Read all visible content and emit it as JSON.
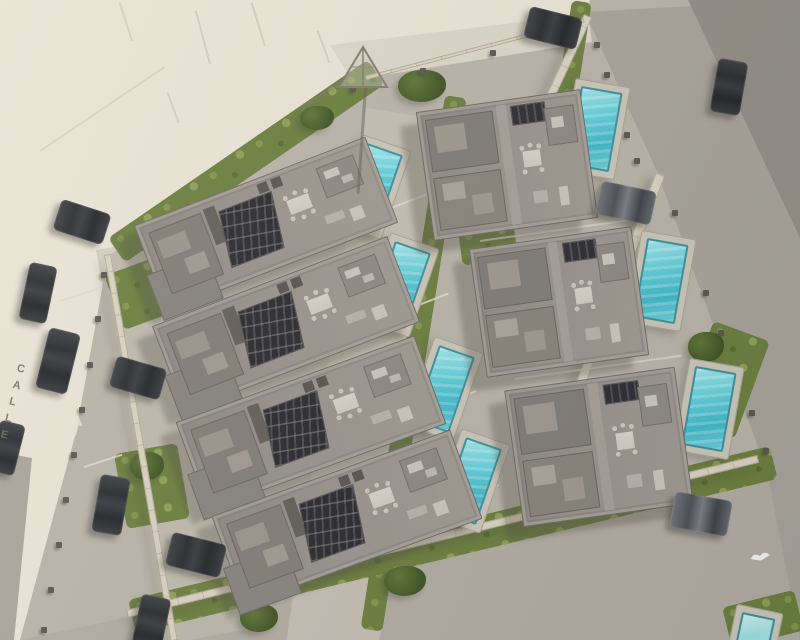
{
  "scene": {
    "description": "Aerial 3D render of a walled residential development with modern villas, rooftop terraces with solar panels, and private turquoise pools, bordered by streets with parked cars",
    "street_label": "CALLE",
    "site": {
      "villas_left_column": 4,
      "villas_right_column": 3,
      "pools_visible": 8,
      "parked_cars": 12
    },
    "colors": {
      "terrain": "#e9e3d6",
      "street": "#c8c3b6",
      "road": "#a5a198",
      "road_dark": "#908c84",
      "concrete": "#b7b2a7",
      "deck": "#c9c4b7",
      "roof": "#918d86",
      "roof_dark": "#7d7972",
      "solar": "#2a2a2e",
      "pool_water": "#52c6d2",
      "pool_light": "#9ce4e8",
      "grass": "#687c3b",
      "wall": "#d8d1c0",
      "car": "#2f3236",
      "shadow": "rgba(72,69,62,0.33)"
    },
    "villas": [
      {
        "id": "villa-L1",
        "type": "left",
        "x": 142,
        "y": 178,
        "w": 248,
        "h": 92,
        "rot": -21
      },
      {
        "id": "villa-L2",
        "type": "left",
        "x": 160,
        "y": 278,
        "w": 252,
        "h": 92,
        "rot": -21
      },
      {
        "id": "villa-L3",
        "type": "left",
        "x": 184,
        "y": 376,
        "w": 254,
        "h": 94,
        "rot": -20
      },
      {
        "id": "villa-L4",
        "type": "left",
        "x": 220,
        "y": 470,
        "w": 254,
        "h": 95,
        "rot": -20
      },
      {
        "id": "villa-R1",
        "type": "right",
        "x": 424,
        "y": 100,
        "w": 166,
        "h": 130,
        "rot": -8
      },
      {
        "id": "villa-R2",
        "type": "right",
        "x": 477,
        "y": 237,
        "w": 164,
        "h": 130,
        "rot": -8
      },
      {
        "id": "villa-R3",
        "type": "right",
        "x": 513,
        "y": 378,
        "w": 172,
        "h": 138,
        "rot": -8
      }
    ],
    "pools": [
      {
        "x": 346,
        "y": 140,
        "w": 52,
        "h": 94,
        "rot": 19,
        "partial": false
      },
      {
        "x": 374,
        "y": 238,
        "w": 52,
        "h": 94,
        "rot": 19,
        "partial": false
      },
      {
        "x": 418,
        "y": 342,
        "w": 52,
        "h": 94,
        "rot": 19,
        "partial": false
      },
      {
        "x": 445,
        "y": 434,
        "w": 52,
        "h": 94,
        "rot": 19,
        "partial": false
      },
      {
        "x": 567,
        "y": 82,
        "w": 56,
        "h": 94,
        "rot": 10,
        "partial": false
      },
      {
        "x": 633,
        "y": 234,
        "w": 56,
        "h": 94,
        "rot": 10,
        "partial": false
      },
      {
        "x": 681,
        "y": 362,
        "w": 56,
        "h": 94,
        "rot": 10,
        "partial": false
      },
      {
        "x": 730,
        "y": 608,
        "w": 48,
        "h": 60,
        "rot": 12,
        "partial": true
      }
    ],
    "cars": [
      {
        "x": 56,
        "y": 206,
        "w": 52,
        "h": 32,
        "rot": 18,
        "tone": "dark-h"
      },
      {
        "x": 24,
        "y": 264,
        "w": 28,
        "h": 58,
        "rot": 12,
        "tone": "dark"
      },
      {
        "x": 42,
        "y": 330,
        "w": 32,
        "h": 62,
        "rot": 14,
        "tone": "dark"
      },
      {
        "x": 96,
        "y": 476,
        "w": 30,
        "h": 58,
        "rot": 10,
        "tone": "dark"
      },
      {
        "x": -6,
        "y": 422,
        "w": 26,
        "h": 52,
        "rot": 14,
        "tone": "dark"
      },
      {
        "x": 136,
        "y": 596,
        "w": 30,
        "h": 56,
        "rot": 12,
        "tone": "dark"
      },
      {
        "x": 112,
        "y": 362,
        "w": 52,
        "h": 32,
        "rot": 16,
        "tone": "dark-h"
      },
      {
        "x": 168,
        "y": 538,
        "w": 56,
        "h": 34,
        "rot": 14,
        "tone": "dark-h"
      },
      {
        "x": 598,
        "y": 186,
        "w": 56,
        "h": 34,
        "rot": 12,
        "tone": "gray"
      },
      {
        "x": 672,
        "y": 496,
        "w": 58,
        "h": 36,
        "rot": 10,
        "tone": "gray"
      },
      {
        "x": 526,
        "y": 12,
        "w": 54,
        "h": 32,
        "rot": 14,
        "tone": "dark-h"
      },
      {
        "x": 714,
        "y": 60,
        "w": 30,
        "h": 54,
        "rot": 10,
        "tone": "dark"
      }
    ],
    "hedges": [
      {
        "x": 108,
        "y": 238,
        "w": 315,
        "h": 30,
        "rot": -34.5
      },
      {
        "x": 572,
        "y": 0,
        "w": 20,
        "h": 150,
        "rot": 9
      },
      {
        "x": 445,
        "y": 95,
        "w": 22,
        "h": 540,
        "rot": 9
      },
      {
        "x": 128,
        "y": 600,
        "w": 660,
        "h": 34,
        "rot": -13.5
      }
    ],
    "grass_patches": [
      {
        "x": 112,
        "y": 262,
        "w": 70,
        "h": 58,
        "rot": -20
      },
      {
        "x": 120,
        "y": 448,
        "w": 64,
        "h": 76,
        "rot": -10
      },
      {
        "x": 460,
        "y": 226,
        "w": 56,
        "h": 36,
        "rot": -8
      },
      {
        "x": 694,
        "y": 328,
        "w": 60,
        "h": 104,
        "rot": 20
      },
      {
        "x": 726,
        "y": 598,
        "w": 74,
        "h": 42,
        "rot": -14
      }
    ],
    "trees": [
      {
        "x": 398,
        "y": 70,
        "w": 48,
        "h": 32
      },
      {
        "x": 300,
        "y": 106,
        "w": 34,
        "h": 24
      },
      {
        "x": 240,
        "y": 604,
        "w": 38,
        "h": 28
      },
      {
        "x": 384,
        "y": 566,
        "w": 42,
        "h": 30
      },
      {
        "x": 130,
        "y": 452,
        "w": 34,
        "h": 28
      },
      {
        "x": 688,
        "y": 332,
        "w": 36,
        "h": 30
      }
    ],
    "walls": [
      {
        "x": 104,
        "y": 255,
        "w": 7,
        "h": 392,
        "rot": -9.8,
        "dir": "v"
      },
      {
        "x": 656,
        "y": 172,
        "w": 10,
        "h": 310,
        "rot": 20.9,
        "dir": "v"
      },
      {
        "x": 584,
        "y": 14,
        "w": 9,
        "h": 166,
        "rot": 25,
        "dir": "v"
      },
      {
        "x": 126,
        "y": 610,
        "w": 650,
        "h": 8,
        "rot": -13.8,
        "dir": "h"
      },
      {
        "x": 365,
        "y": 76,
        "w": 226,
        "h": 4,
        "rot": -14.7,
        "dir": "h"
      }
    ],
    "posts": [
      [
        101,
        272
      ],
      [
        95,
        316
      ],
      [
        87,
        362
      ],
      [
        79,
        407
      ],
      [
        71,
        452
      ],
      [
        63,
        497
      ],
      [
        56,
        542
      ],
      [
        48,
        587
      ],
      [
        41,
        627
      ],
      [
        672,
        210
      ],
      [
        688,
        250
      ],
      [
        703,
        290
      ],
      [
        718,
        330
      ],
      [
        733,
        370
      ],
      [
        749,
        410
      ],
      [
        763,
        448
      ],
      [
        594,
        42
      ],
      [
        604,
        72
      ],
      [
        614,
        102
      ],
      [
        624,
        132
      ],
      [
        634,
        158
      ],
      [
        350,
        86
      ],
      [
        420,
        68
      ],
      [
        490,
        50
      ],
      [
        556,
        34
      ]
    ],
    "lines": [
      {
        "x": 352,
        "y": 222,
        "len": 80,
        "rot": -21,
        "c": "#ded9cc",
        "t": 2
      },
      {
        "x": 372,
        "y": 322,
        "len": 82,
        "rot": -21,
        "c": "#ded9cc",
        "t": 2
      },
      {
        "x": 398,
        "y": 420,
        "len": 84,
        "rot": -21,
        "c": "#ded9cc",
        "t": 2
      },
      {
        "x": 420,
        "y": 514,
        "len": 84,
        "rot": -21,
        "c": "#ded9cc",
        "t": 2
      },
      {
        "x": 480,
        "y": 240,
        "len": 160,
        "rot": -8,
        "c": "#d6d1c4",
        "t": 2
      },
      {
        "x": 515,
        "y": 378,
        "len": 168,
        "rot": -8,
        "c": "#d6d1c4",
        "t": 2
      },
      {
        "x": 60,
        "y": 300,
        "len": 40,
        "rot": -18,
        "c": "#ddd8cb",
        "t": 2
      },
      {
        "x": 84,
        "y": 466,
        "len": 40,
        "rot": -18,
        "c": "#ddd8cb",
        "t": 2
      },
      {
        "x": 120,
        "y": 2,
        "len": 40,
        "rot": 72,
        "c": "#cfc8b8",
        "t": 1.5
      },
      {
        "x": 196,
        "y": 10,
        "len": 55,
        "rot": 75,
        "c": "#cfc8b8",
        "t": 1.5
      },
      {
        "x": 168,
        "y": 92,
        "len": 32,
        "rot": 70,
        "c": "#cfc8b8",
        "t": 1.5
      },
      {
        "x": 318,
        "y": 30,
        "len": 34,
        "rot": 70,
        "c": "#cfc8b8",
        "t": 1.5
      },
      {
        "x": 252,
        "y": 2,
        "len": 45,
        "rot": 73,
        "c": "#cfc8b8",
        "t": 1.5
      },
      {
        "x": 40,
        "y": 150,
        "len": 150,
        "rot": -34,
        "c": "#d5cebe",
        "t": 1.5
      }
    ]
  }
}
